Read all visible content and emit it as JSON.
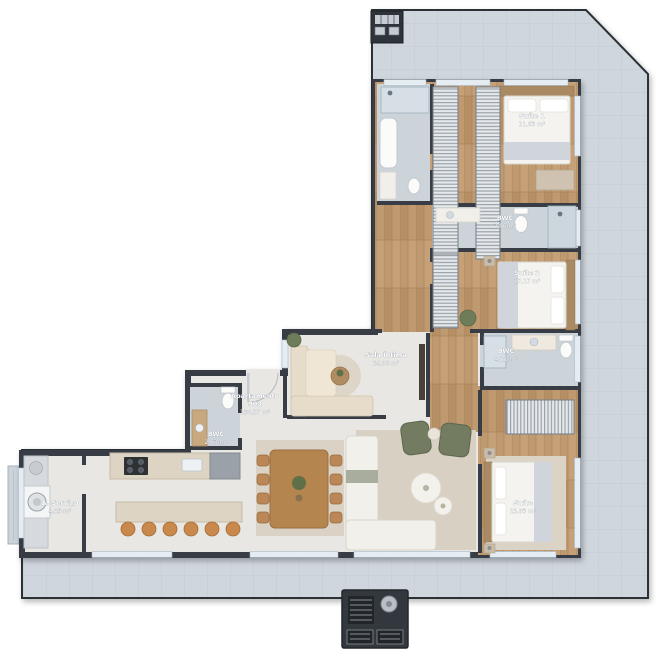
{
  "unit": {
    "label": "Apartamento",
    "number": "903",
    "area": "158,27 m²"
  },
  "rooms": [
    {
      "name": "Suíte 1",
      "area": "21,63 m²"
    },
    {
      "name": "BWC",
      "area": "2,96 m²"
    },
    {
      "name": "Suíte 2",
      "area": "17,17 m²"
    },
    {
      "name": "BWC",
      "area": "4,21 m²"
    },
    {
      "name": "Sala Íntima",
      "area": "14,96 m²"
    },
    {
      "name": "BWC",
      "area": "2,63 m²"
    },
    {
      "name": "A. Serviço",
      "area": "4,55 m²"
    },
    {
      "name": "Suíte",
      "area": "15,93 m²"
    }
  ],
  "colors": {
    "page": "#ffffff",
    "deck_tile": "#cfd6dd",
    "wall": "#383d44",
    "interior_floor": "#e8e7e4",
    "wood_floor": "#bf9a70",
    "bath_tile": "#ccd4da",
    "label_text": "#ffffff",
    "stool_accent": "#c9894d",
    "armchair_green": "#737c61"
  }
}
